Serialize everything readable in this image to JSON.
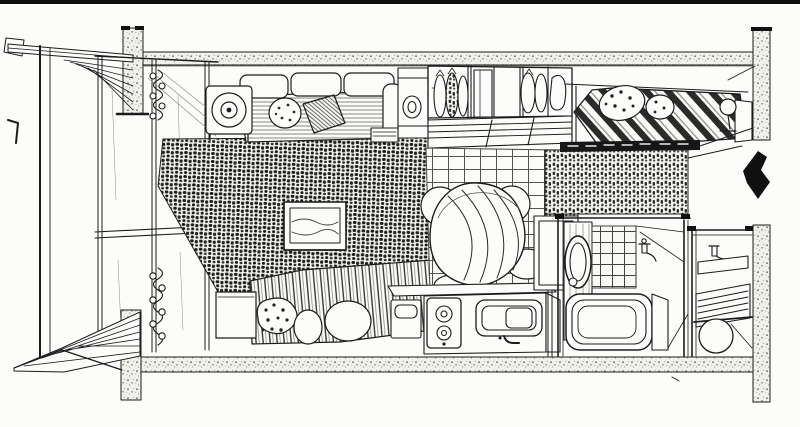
{
  "scene": {
    "kind": "hand-drawn cutaway floor plan sketch of a studio apartment",
    "paper_color": "#fcfcfa",
    "ink_color": "#1c1c1c",
    "label": "studio apartment cutaway perspective drawing"
  },
  "palette": {
    "wall_stipple": "#8a8a85",
    "rug_dark": "#1d1d1d",
    "arrow_black": "#101010"
  },
  "rooms": {
    "balcony": {
      "label": "balcony with railing, eave and plank floor"
    },
    "living": {
      "label": "living area with sofa, shag rug and television"
    },
    "sleeping": {
      "label": "bed with striped blanket, pillows and nightstand"
    },
    "closet": {
      "label": "open closet with hanging clothes and slatted base"
    },
    "dining": {
      "label": "dining area with round draped table and chairs on tile floor"
    },
    "kitchen": {
      "label": "kitchenette with two-burner stove, sink and bin"
    },
    "loft_bed": {
      "label": "raised bed with diagonal striped duvet and lamp"
    },
    "bathroom": {
      "label": "bathroom with bathtub, mirror panel and tiled wall"
    },
    "entry": {
      "label": "entry room with tap, duckboard slats and round basin"
    }
  },
  "furniture": {
    "sofa": {
      "label": "three-cushion sofa with throw pillows"
    },
    "side_table": {
      "label": "round side table"
    },
    "tv": {
      "label": "television set on rug"
    },
    "dining_table": {
      "label": "round table with striped cloth"
    },
    "stove": {
      "label": "two-burner stove"
    },
    "sink": {
      "label": "kitchen sink with faucet"
    },
    "bathtub": {
      "label": "bathtub"
    },
    "mirror": {
      "label": "oval mirror"
    },
    "curtain": {
      "label": "ring curtain at window"
    },
    "hanging_curtain": {
      "label": "dark hanging curtain under loft bed"
    }
  },
  "annotations": {
    "entrance_arrow": {
      "direction": "left",
      "label": "entrance direction arrow"
    }
  }
}
